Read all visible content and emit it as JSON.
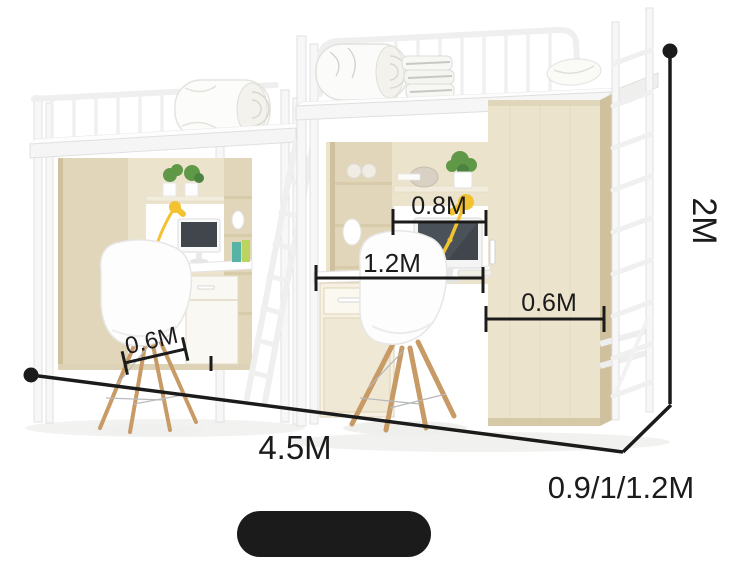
{
  "scene": {
    "caption": "双人公寓床",
    "background": "#ffffff",
    "annotation_color": "#1b1b1b"
  },
  "labels": {
    "height": "2M",
    "length": "4.5M",
    "depth_options": "0.9/1/1.2M",
    "hutch_width": "0.8M",
    "desk_width": "1.2M",
    "wardrobe_width": "0.6M",
    "left_desk_depth": "0.6M"
  },
  "palette": {
    "ink": "#1b1b1b",
    "wood_light": "#ece3cd",
    "wood_mid": "#e2d6ba",
    "wood_dark": "#cfc09e",
    "frame_white": "#f7f7f7",
    "frame_edge": "#e0e0e0",
    "lamp_yellow": "#f2c230",
    "plant_green": "#5f9948",
    "screen_dark": "#41464c",
    "chair_wood": "#c79a66",
    "pill_text": "#ffffff"
  }
}
